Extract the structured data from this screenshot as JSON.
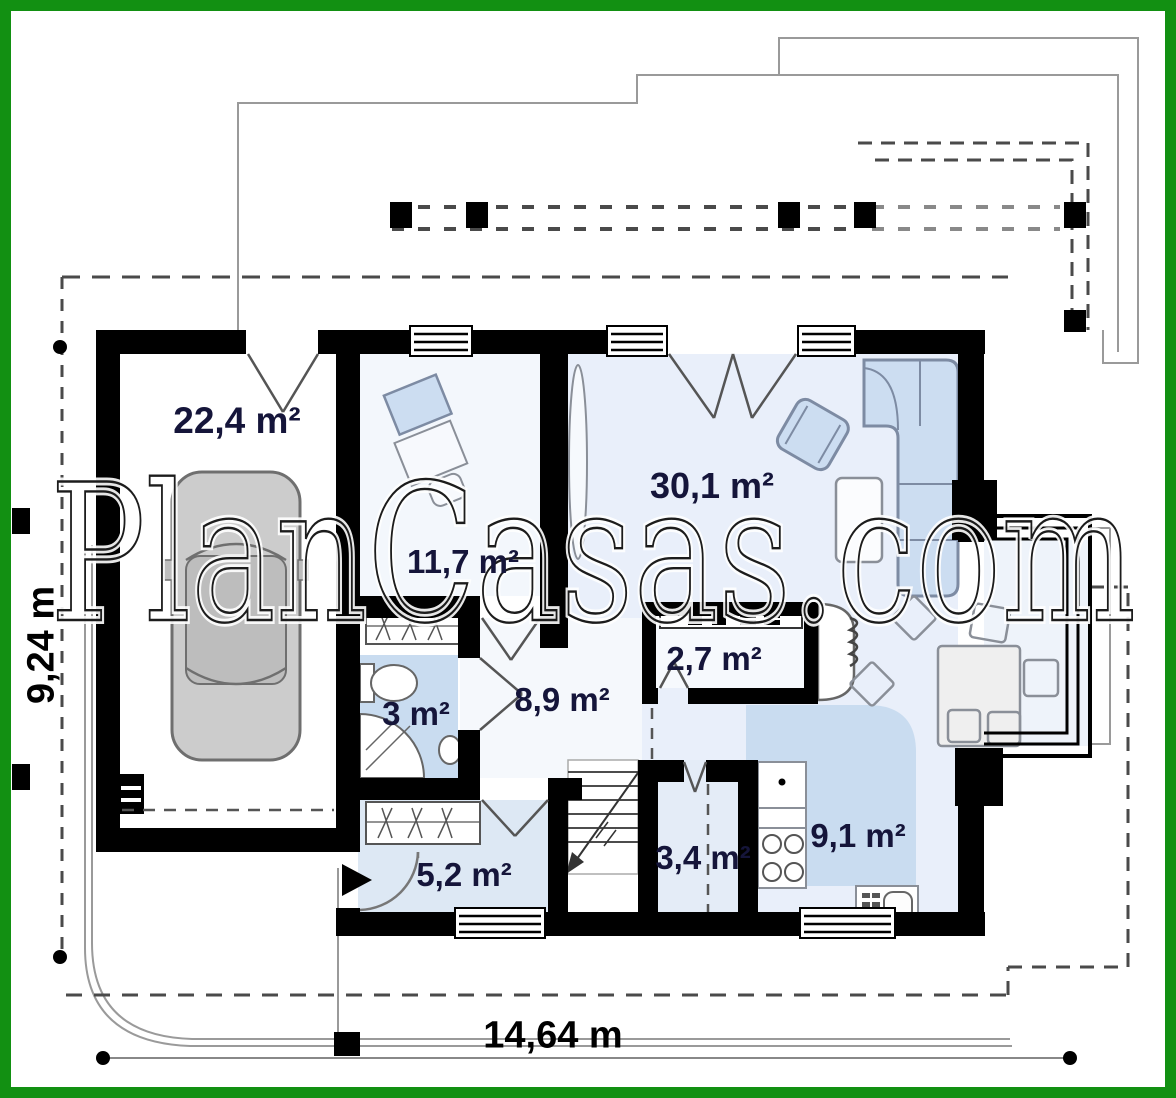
{
  "watermark": {
    "text": "PlanCasas.com"
  },
  "dimensions": {
    "width_label": "14,64 m",
    "height_label": "9,24 m"
  },
  "rooms": {
    "garage": {
      "name": "garage",
      "area": "22,4 m²"
    },
    "bedroom": {
      "name": "bedroom",
      "area": "11,7 m²"
    },
    "living_room": {
      "name": "living-room",
      "area": "30,1 m²"
    },
    "pantry": {
      "name": "pantry",
      "area": "2,7 m²"
    },
    "bathroom": {
      "name": "bathroom",
      "area": "3 m²"
    },
    "hall": {
      "name": "hall",
      "area": "8,9 m²"
    },
    "vestibule": {
      "name": "vestibule",
      "area": "5,2 m²"
    },
    "corridor": {
      "name": "corridor",
      "area": "3,4 m²"
    },
    "kitchen": {
      "name": "kitchen",
      "area": "9,1 m²"
    }
  },
  "colors": {
    "frame_green": "#129012",
    "wall_black": "#000000",
    "wet_floor_blue": "#c9dcf0",
    "living_floor_blue": "#e9effa",
    "furniture_blue": "#ccddf1",
    "label_ink": "#15153a"
  }
}
